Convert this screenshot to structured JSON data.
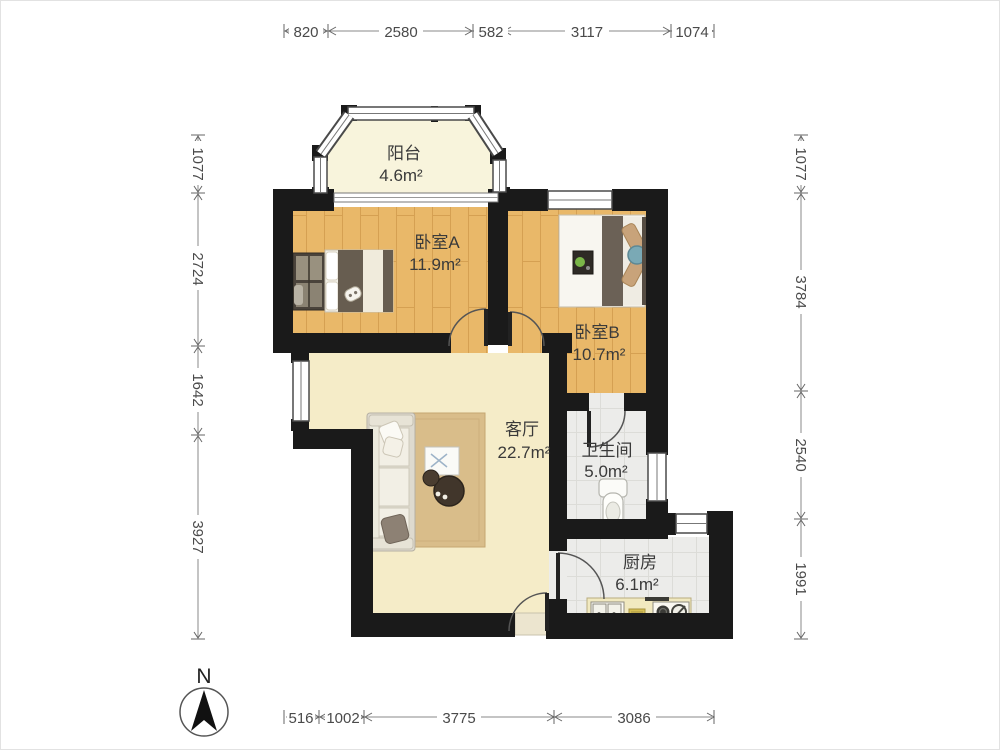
{
  "rooms": {
    "balcony": {
      "name": "阳台",
      "area": "4.6m²"
    },
    "bedroomA": {
      "name": "卧室A",
      "area": "11.9m²"
    },
    "bedroomB": {
      "name": "卧室B",
      "area": "10.7m²"
    },
    "living": {
      "name": "客厅",
      "area": "22.7m²"
    },
    "bathroom": {
      "name": "卫生间",
      "area": "5.0m²"
    },
    "kitchen": {
      "name": "厨房",
      "area": "6.1m²"
    }
  },
  "dimensions": {
    "top": [
      "820",
      "2580",
      "582",
      "3117",
      "1074"
    ],
    "bottom": [
      "516",
      "1002",
      "3775",
      "3086"
    ],
    "left": [
      "1077",
      "2724",
      "1642",
      "3927"
    ],
    "right": [
      "1077",
      "3784",
      "2540",
      "1991"
    ]
  },
  "compass": {
    "north": "N"
  },
  "colors": {
    "wall": "#1a1a1a",
    "wood_floor": "#e9b869",
    "living_floor": "#f5ecc8",
    "tile_floor": "#ececea",
    "balcony_floor": "#f8f4dc",
    "rug": "#d9bd8a",
    "counter": "#f1e9c0",
    "dim_line": "#777777"
  }
}
